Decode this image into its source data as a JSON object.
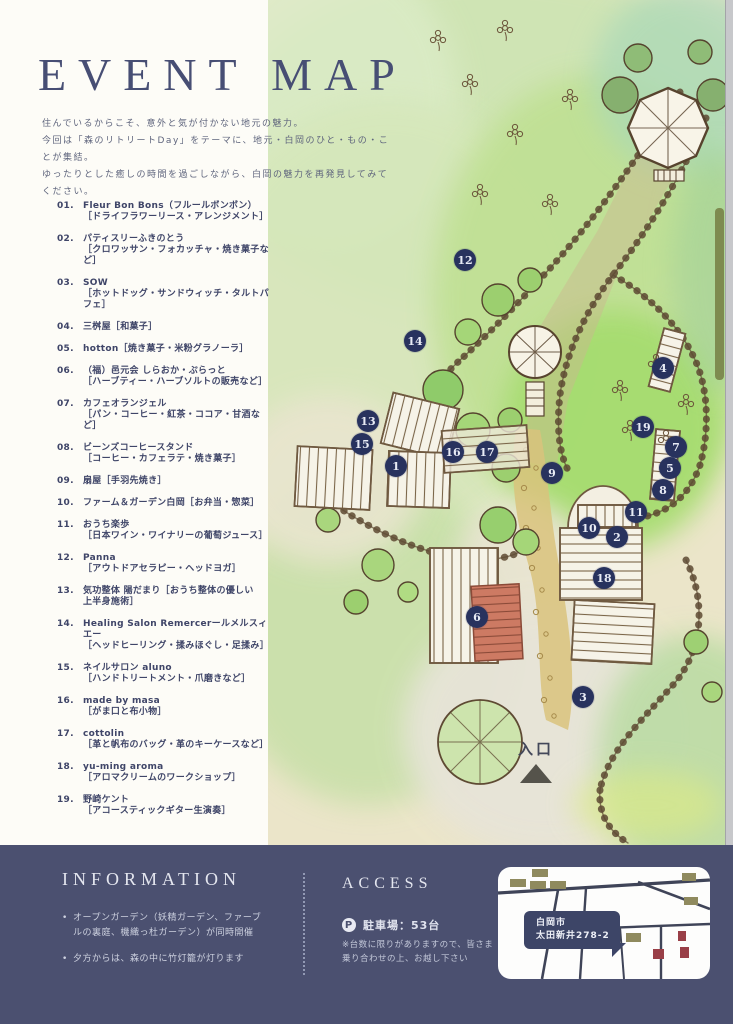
{
  "header": {
    "title": "EVENT MAP",
    "intro_lines": [
      "住んでいるからこそ、意外と気が付かない地元の魅力。",
      "今回は「森のリトリートDay」をテーマに、地元・白岡のひと・もの・ことが集結。",
      "ゆったりとした癒しの時間を過ごしながら、白岡の魅力を再発見してみてください。"
    ]
  },
  "vendors": [
    {
      "no": "01.",
      "lines": [
        "Fleur Bon Bons（フルールボンボン）",
        "［ドライフラワーリース・アレンジメント］"
      ]
    },
    {
      "no": "02.",
      "lines": [
        "パティスリーふきのとう",
        "［クロワッサン・フォカッチャ・焼き菓子など］"
      ]
    },
    {
      "no": "03.",
      "lines": [
        "SOW",
        "［ホットドッグ・サンドウィッチ・タルトパフェ］"
      ]
    },
    {
      "no": "04.",
      "lines": [
        "三桝屋［和菓子］"
      ]
    },
    {
      "no": "05.",
      "lines": [
        "hotton［焼き菓子・米粉グラノーラ］"
      ]
    },
    {
      "no": "06.",
      "lines": [
        "（福）邑元会 しらおか・ぷらっと",
        "［ハーブティー・ハーブソルトの販売など］"
      ]
    },
    {
      "no": "07.",
      "lines": [
        "カフェオランジェル",
        "［パン・コーヒー・紅茶・ココア・甘酒など］"
      ]
    },
    {
      "no": "08.",
      "lines": [
        "ビーンズコーヒースタンド",
        "［コーヒー・カフェラテ・焼き菓子］"
      ]
    },
    {
      "no": "09.",
      "lines": [
        "扇屋［手羽先焼き］"
      ]
    },
    {
      "no": "10.",
      "lines": [
        "ファーム＆ガーデン白岡［お弁当・惣菜］"
      ]
    },
    {
      "no": "11.",
      "lines": [
        "おうち楽歩",
        "［日本ワイン・ワイナリーの葡萄ジュース］"
      ]
    },
    {
      "no": "12.",
      "lines": [
        "Panna",
        "［アウトドアセラピー・ヘッドヨガ］"
      ]
    },
    {
      "no": "13.",
      "lines": [
        "気功整体 陽だまり［おうち整体の優しい",
        "上半身施術］"
      ]
    },
    {
      "no": "14.",
      "lines": [
        "Healing Salon Remercerールメルスィエー",
        "［ヘッドヒーリング・揉みほぐし・足揉み］"
      ]
    },
    {
      "no": "15.",
      "lines": [
        "ネイルサロン aluno",
        "［ハンドトリートメント・爪磨きなど］"
      ]
    },
    {
      "no": "16.",
      "lines": [
        "made by masa",
        "［がま口と布小物］"
      ]
    },
    {
      "no": "17.",
      "lines": [
        "cottolin",
        "［革と帆布のバッグ・革のキーケースなど］"
      ]
    },
    {
      "no": "18.",
      "lines": [
        "yu-ming aroma",
        "［アロマクリームのワークショップ］"
      ]
    },
    {
      "no": "19.",
      "lines": [
        "野崎ケント",
        "［アコースティックギター生演奏］"
      ]
    }
  ],
  "map": {
    "entrance_label": "入口",
    "markers": [
      {
        "n": "1",
        "x": 128,
        "y": 466
      },
      {
        "n": "2",
        "x": 349,
        "y": 537
      },
      {
        "n": "3",
        "x": 315,
        "y": 697
      },
      {
        "n": "4",
        "x": 395,
        "y": 368
      },
      {
        "n": "5",
        "x": 402,
        "y": 468
      },
      {
        "n": "6",
        "x": 209,
        "y": 617
      },
      {
        "n": "7",
        "x": 408,
        "y": 447
      },
      {
        "n": "8",
        "x": 395,
        "y": 490
      },
      {
        "n": "9",
        "x": 284,
        "y": 473
      },
      {
        "n": "10",
        "x": 321,
        "y": 528
      },
      {
        "n": "11",
        "x": 368,
        "y": 512
      },
      {
        "n": "12",
        "x": 197,
        "y": 260
      },
      {
        "n": "13",
        "x": 100,
        "y": 421
      },
      {
        "n": "14",
        "x": 147,
        "y": 341
      },
      {
        "n": "15",
        "x": 94,
        "y": 444
      },
      {
        "n": "16",
        "x": 185,
        "y": 452
      },
      {
        "n": "17",
        "x": 219,
        "y": 452
      },
      {
        "n": "18",
        "x": 336,
        "y": 578
      },
      {
        "n": "19",
        "x": 375,
        "y": 427
      }
    ]
  },
  "footer": {
    "information": {
      "heading": "INFORMATION",
      "bullets": [
        "オープンガーデン（妖精ガーデン、ファーブルの裏庭、機織っ杜ガーデン）が同時開催",
        "夕方からは、森の中に竹灯籠が灯ります"
      ]
    },
    "access": {
      "heading": "ACCESS",
      "parking_icon": "P",
      "parking_label": "駐車場：53台",
      "note": "※台数に限りがありますので、皆さま乗り合わせの上、お越し下さい",
      "address_lines": [
        "白岡市",
        "太田新井278-2"
      ]
    }
  },
  "colors": {
    "accent_navy": "#474e74",
    "footer_bg": "#4b5070",
    "badge": "#28325e",
    "map_cream": "#ebe5c9",
    "lawn_green": "#a8dd72",
    "khaki_box": "#8f8a5e",
    "red_box": "#993f47"
  }
}
